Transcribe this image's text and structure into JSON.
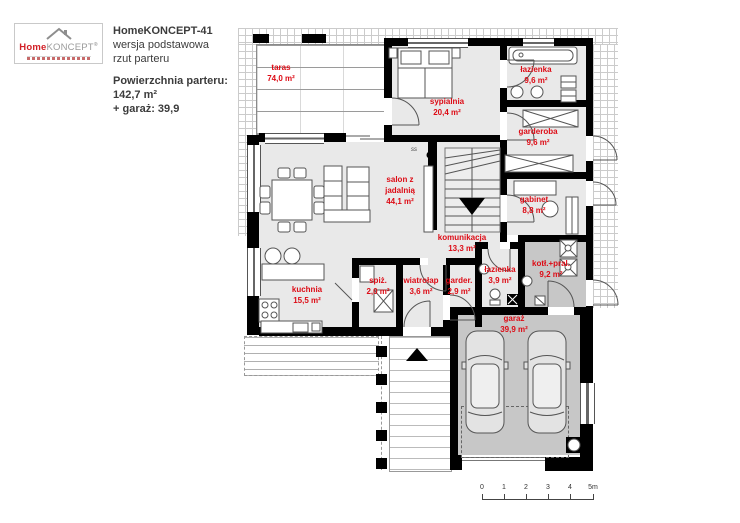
{
  "header": {
    "logo": {
      "home": "Home",
      "koncept": "KONCEPT",
      "reg": "®"
    },
    "title": "HomeKONCEPT-41",
    "line1": "wersja podstawowa",
    "line2": "rzut parteru",
    "area_label": "Powierzchnia parteru:",
    "area_value": "142,7 m²",
    "garage_line": "+ garaż: 39,9"
  },
  "rooms": [
    {
      "id": "taras",
      "lines": [
        "taras",
        "74,0 m²"
      ]
    },
    {
      "id": "sypialnia",
      "lines": [
        "sypialnia",
        "20,4 m²"
      ]
    },
    {
      "id": "lazienka-top",
      "lines": [
        "łazienka",
        "9,6 m²"
      ]
    },
    {
      "id": "garderoba",
      "lines": [
        "garderoba",
        "9,6 m²"
      ]
    },
    {
      "id": "gabinet",
      "lines": [
        "gabinet",
        "8,8 m²"
      ]
    },
    {
      "id": "salon",
      "lines": [
        "salon z",
        "jadalnią",
        "44,1 m²"
      ]
    },
    {
      "id": "komunikacja",
      "lines": [
        "komunikacja",
        "13,3 m²"
      ]
    },
    {
      "id": "kuchnia",
      "lines": [
        "kuchnia",
        "15,5 m²"
      ]
    },
    {
      "id": "spiz",
      "lines": [
        "spiż.",
        "2,0 m²"
      ]
    },
    {
      "id": "wiatrolap",
      "lines": [
        "wiatrołap",
        "3,6 m²"
      ]
    },
    {
      "id": "garder",
      "lines": [
        "garder.",
        "2,9 m²"
      ]
    },
    {
      "id": "lazienka-small",
      "lines": [
        "łazienka",
        "3,9 m²"
      ]
    },
    {
      "id": "kotl-pral",
      "lines": [
        "kotł.+pral.",
        "9,2 m²"
      ]
    },
    {
      "id": "garaz",
      "lines": [
        "garaż",
        "39,9 m²"
      ]
    }
  ],
  "markers": {
    "stair_note": "ss"
  },
  "scale": {
    "labels": [
      "0",
      "1",
      "2",
      "3",
      "4",
      "5m"
    ]
  },
  "colors": {
    "label_red": "#dd0b15",
    "wall": "#000000",
    "floor": "#e9e9e9",
    "floor_dark": "#c7c7c7"
  }
}
